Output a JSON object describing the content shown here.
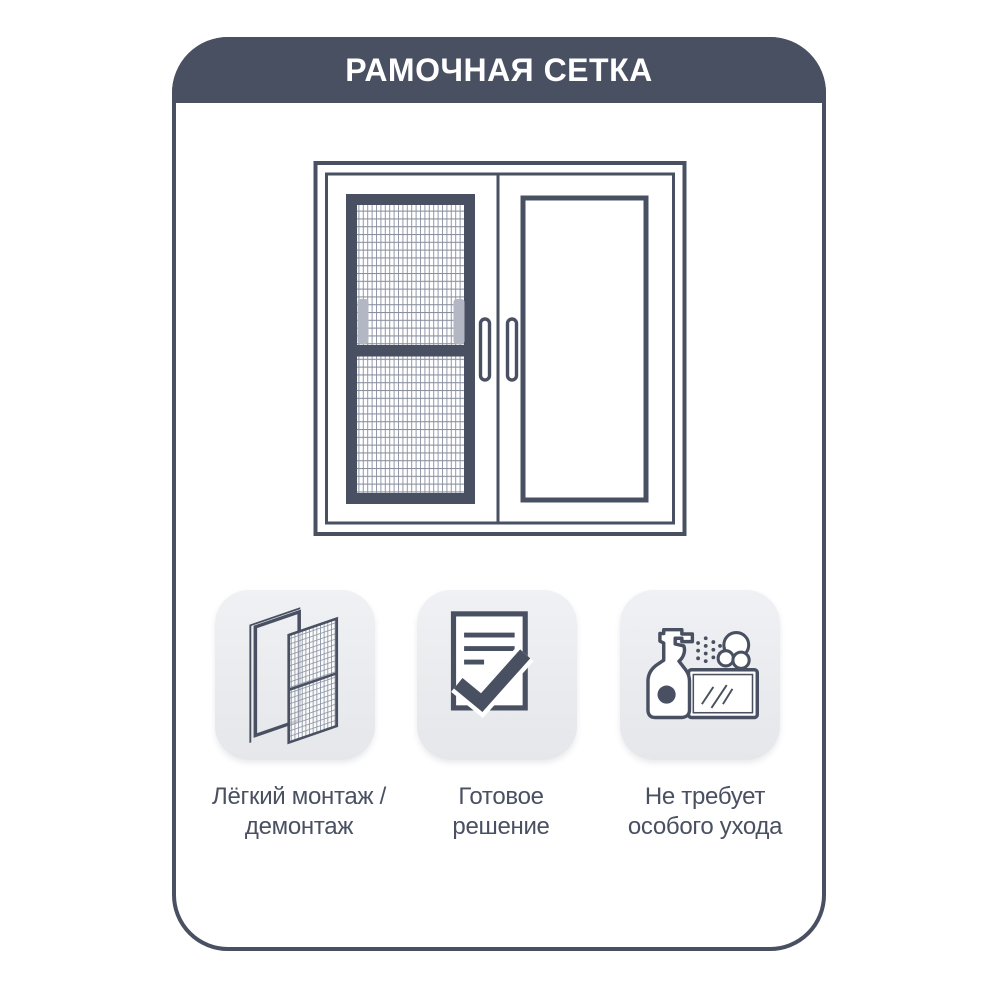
{
  "header": {
    "title": "РАМОЧНАЯ СЕТКА"
  },
  "illustration": {
    "name": "double casement window with frame mosquito net installed on left sash"
  },
  "features": [
    {
      "icon": "mesh-frame-icon",
      "label_line1": "Лёгкий монтаж /",
      "label_line2": "демонтаж"
    },
    {
      "icon": "checklist-icon",
      "label_line1": "Готовое",
      "label_line2": "решение"
    },
    {
      "icon": "spray-bottle-icon",
      "label_line1": "Не требует",
      "label_line2": "особого ухода"
    }
  ],
  "colors": {
    "accent": "#495062",
    "header_bg": "#495062",
    "header_text": "#ffffff",
    "tile_bg": "#eceef1",
    "mesh_tab": "#b2b7c3",
    "mesh_line": "#8e95a4",
    "page_bg": "#ffffff"
  }
}
